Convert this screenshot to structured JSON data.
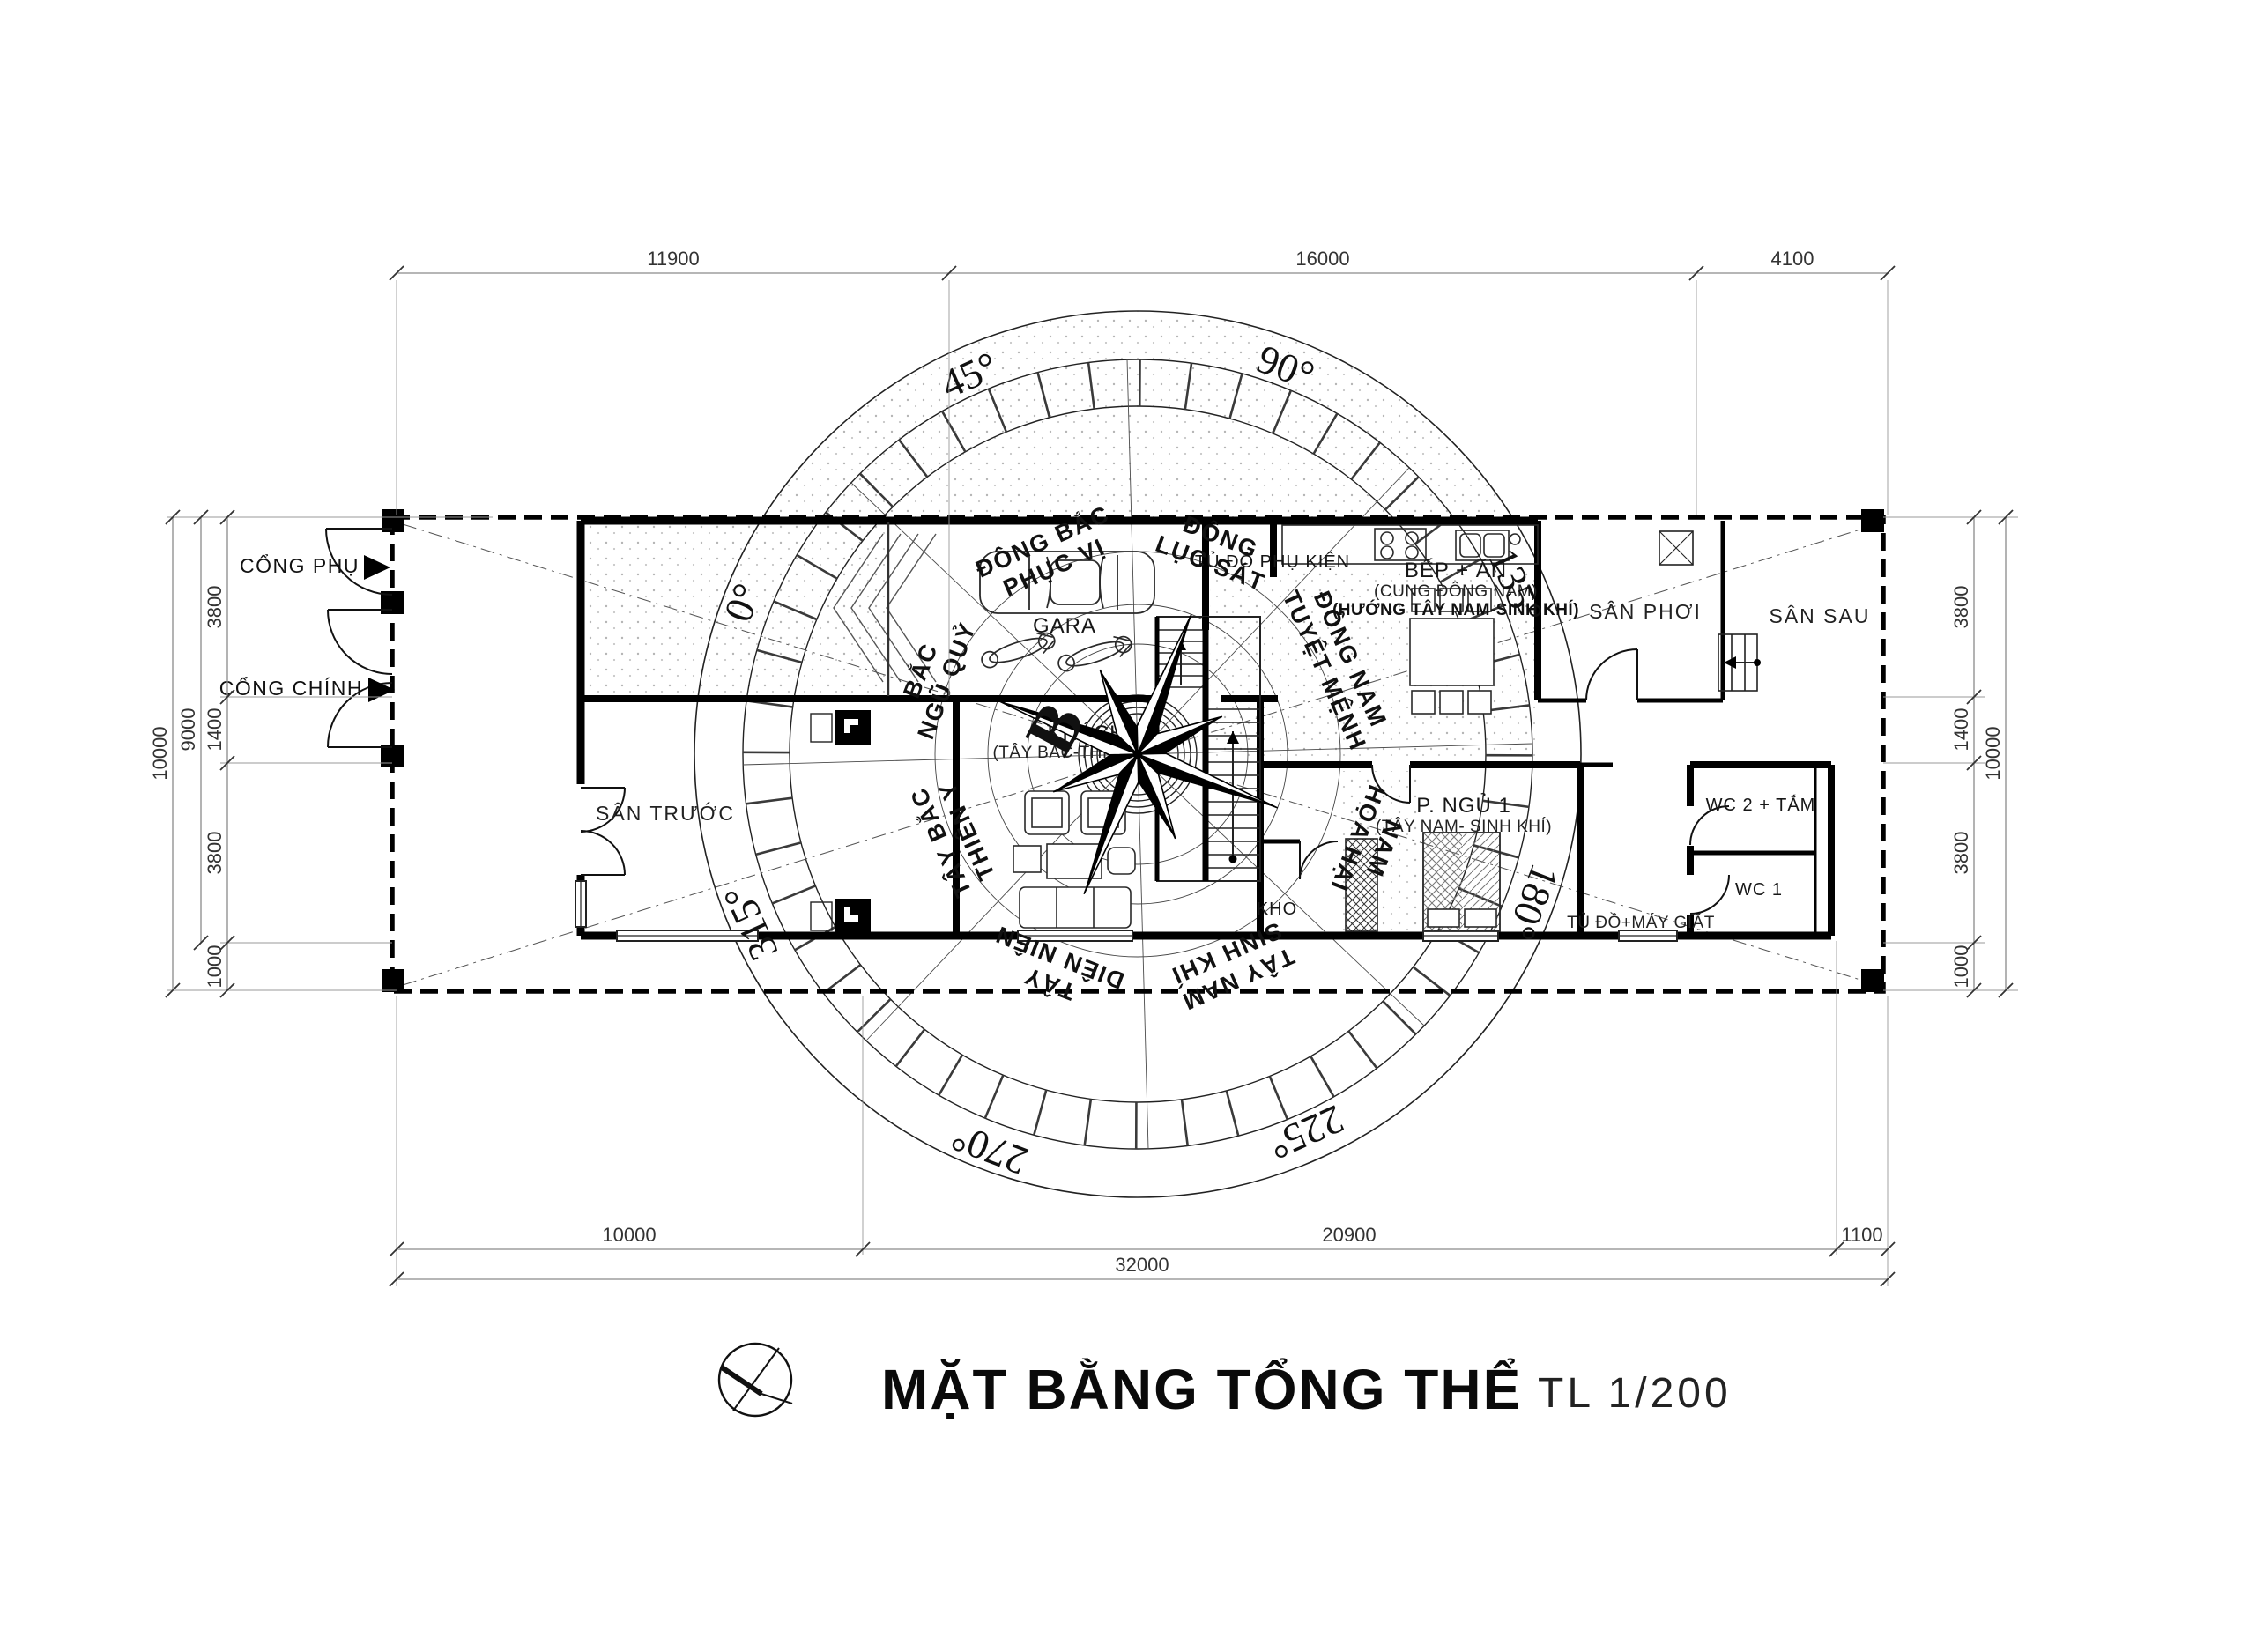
{
  "title": {
    "name": "MẶT BẰNG TỔNG THỂ",
    "scale": "TL 1/200"
  },
  "dims": {
    "top": [
      "11900",
      "16000",
      "4100"
    ],
    "bottom": [
      "10000",
      "20900",
      "1100"
    ],
    "bottom_total": "32000",
    "left": [
      "3800",
      "1400",
      "3800",
      "1000"
    ],
    "left_9000": "9000",
    "left_10000": "10000",
    "right": [
      "3800",
      "1400",
      "3800",
      "1000"
    ],
    "right_10000": "10000"
  },
  "site": {
    "front_yard": "SÂN TRƯỚC",
    "back_yard": "SÂN SAU",
    "drying_yard": "SÂN PHƠI",
    "gate_side": "CỔNG PHỤ",
    "gate_main": "CỔNG CHÍNH"
  },
  "rooms": {
    "garage": "GARA",
    "living": "KHÁCH",
    "living_note": "(TÂY BẮC-THIÊN Y)",
    "kitchen": "BẾP + ĂN",
    "kitchen_note1": "(CUNG ĐÔNG NAM)",
    "kitchen_note2": "(HƯỚNG TÂY NAM-SINH KHÍ)",
    "closet": "TỦ ĐỒ PHỤ KIỆN",
    "bedroom1": "P. NGỦ 1",
    "bedroom1_note": "(TÂY NAM- SINH KHÍ)",
    "storage": "KHO",
    "wc2": "WC 2 + TẮM",
    "wc1": "WC 1",
    "laundry": "TỦ ĐỒ+MÁY GIẶT"
  },
  "compass": {
    "north": "B",
    "degrees": [
      "0°",
      "45°",
      "90°",
      "135°",
      "180°",
      "225°",
      "270°",
      "315°"
    ],
    "sectors": [
      {
        "dir": "BẮC",
        "cung": "NGŨ QUỶ"
      },
      {
        "dir": "ĐÔNG BẮC",
        "cung": "PHỤC VỊ"
      },
      {
        "dir": "ĐÔNG",
        "cung": "LỤC SÁT"
      },
      {
        "dir": "ĐÔNG NAM",
        "cung": "TUYỆT MỆNH"
      },
      {
        "dir": "NAM",
        "cung": "HỌA HẠI"
      },
      {
        "dir": "TÂY NAM",
        "cung": "SINH KHÍ"
      },
      {
        "dir": "TÂY",
        "cung": "DIÊN NIÊN"
      },
      {
        "dir": "TÂY BẮC",
        "cung": "THIÊN Y"
      }
    ]
  }
}
